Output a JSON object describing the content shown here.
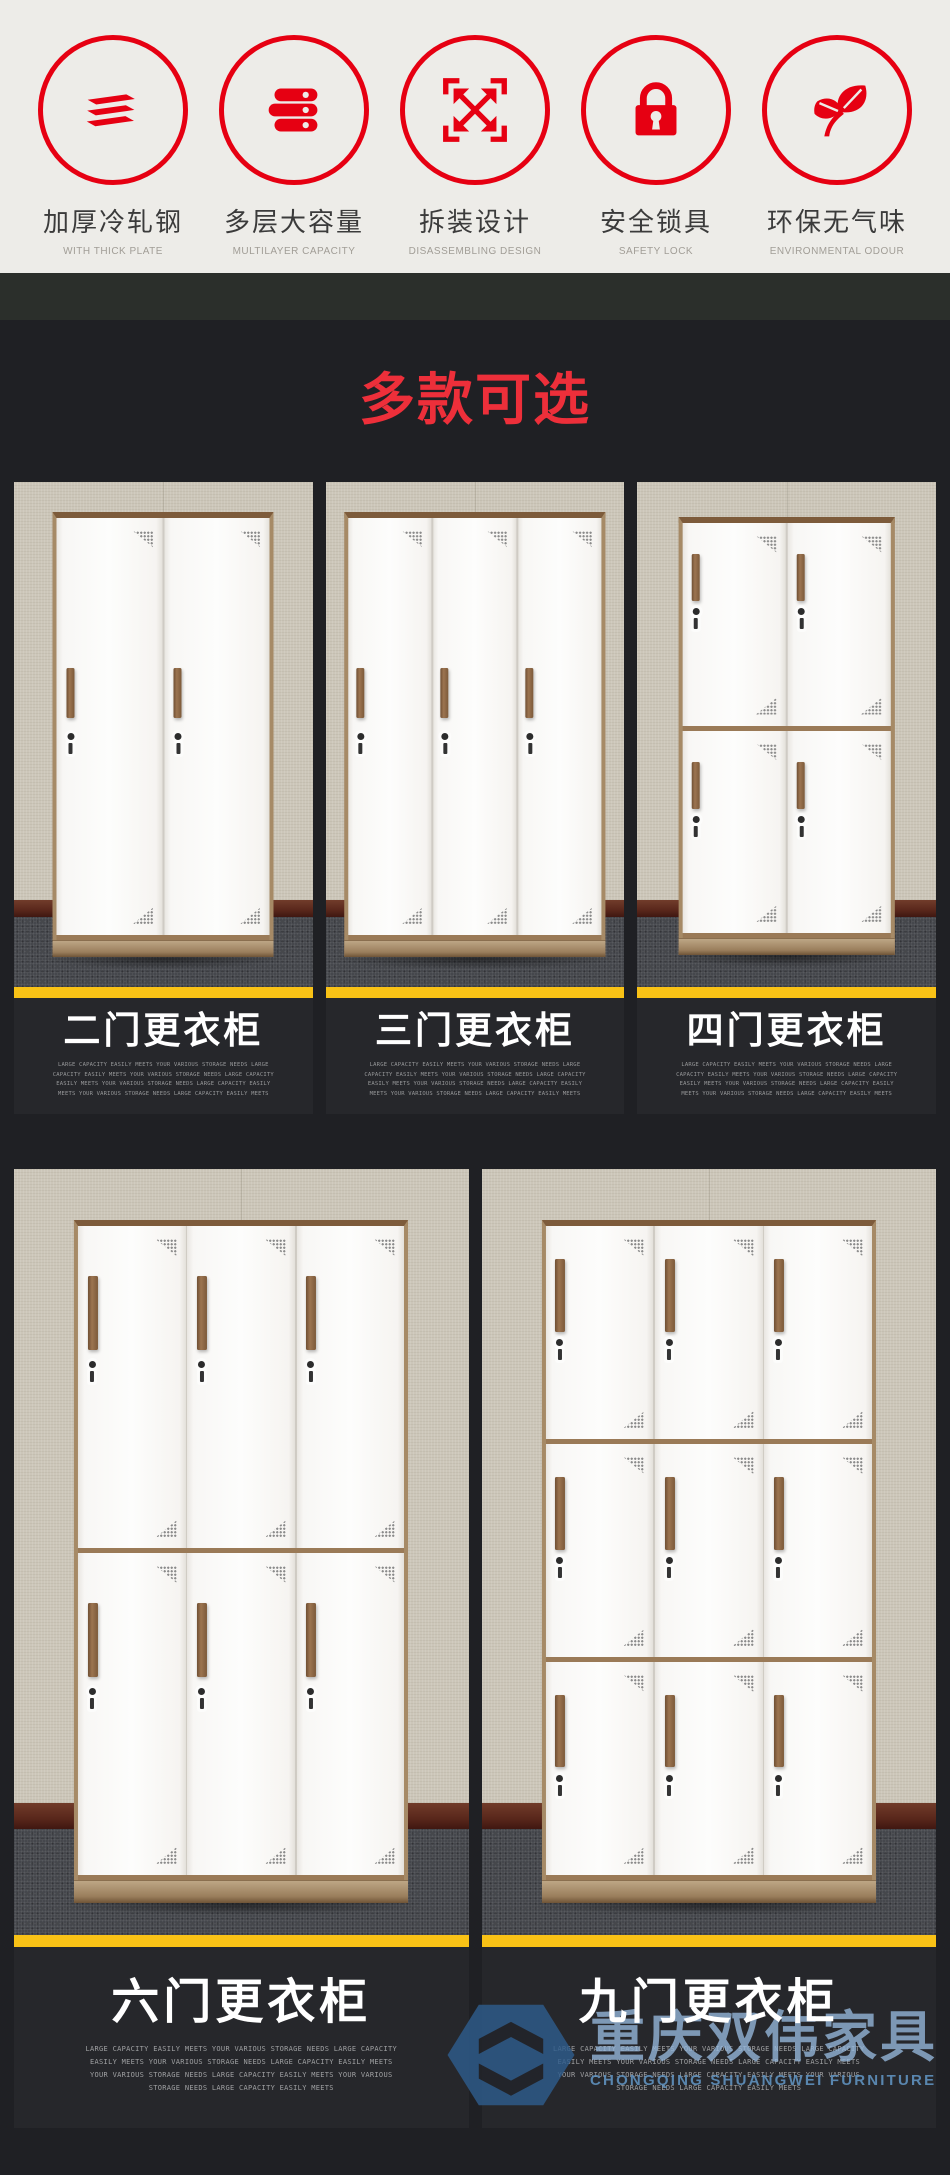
{
  "features": [
    {
      "icon": "layers-icon",
      "label": "加厚冷轧钢",
      "sublabel": "WITH THICK PLATE"
    },
    {
      "icon": "drawers-icon",
      "label": "多层大容量",
      "sublabel": "MULTILAYER CAPACITY"
    },
    {
      "icon": "disassemble-icon",
      "label": "拆装设计",
      "sublabel": "DISASSEMBLING DESIGN"
    },
    {
      "icon": "lock-icon",
      "label": "安全锁具",
      "sublabel": "SAFETY LOCK"
    },
    {
      "icon": "leaf-icon",
      "label": "环保无气味",
      "sublabel": "ENVIRONMENTAL ODOUR"
    }
  ],
  "section_title": "多款可选",
  "products": [
    {
      "name": "二门更衣柜",
      "doors": 2,
      "cols": 2,
      "rows": 1,
      "grid_row": 1,
      "desc": "LARGE CAPACITY EASILY MEETS YOUR VARIOUS STORAGE NEEDS LARGE CAPACITY EASILY MEETS YOUR VARIOUS STORAGE NEEDS LARGE CAPACITY EASILY MEETS YOUR VARIOUS STORAGE NEEDS LARGE CAPACITY EASILY MEETS YOUR VARIOUS STORAGE NEEDS LARGE CAPACITY EASILY MEETS"
    },
    {
      "name": "三门更衣柜",
      "doors": 3,
      "cols": 3,
      "rows": 1,
      "grid_row": 1,
      "desc": "LARGE CAPACITY EASILY MEETS YOUR VARIOUS STORAGE NEEDS LARGE CAPACITY EASILY MEETS YOUR VARIOUS STORAGE NEEDS LARGE CAPACITY EASILY MEETS YOUR VARIOUS STORAGE NEEDS LARGE CAPACITY EASILY MEETS YOUR VARIOUS STORAGE NEEDS LARGE CAPACITY EASILY MEETS"
    },
    {
      "name": "四门更衣柜",
      "doors": 4,
      "cols": 2,
      "rows": 2,
      "grid_row": 1,
      "desc": "LARGE CAPACITY EASILY MEETS YOUR VARIOUS STORAGE NEEDS LARGE CAPACITY EASILY MEETS YOUR VARIOUS STORAGE NEEDS LARGE CAPACITY EASILY MEETS YOUR VARIOUS STORAGE NEEDS LARGE CAPACITY EASILY MEETS YOUR VARIOUS STORAGE NEEDS LARGE CAPACITY EASILY MEETS"
    },
    {
      "name": "六门更衣柜",
      "doors": 6,
      "cols": 3,
      "rows": 2,
      "grid_row": 2,
      "desc": "LARGE CAPACITY EASILY MEETS YOUR VARIOUS STORAGE NEEDS LARGE CAPACITY EASILY MEETS YOUR VARIOUS STORAGE NEEDS LARGE CAPACITY EASILY MEETS YOUR VARIOUS STORAGE NEEDS LARGE CAPACITY EASILY MEETS YOUR VARIOUS STORAGE NEEDS LARGE CAPACITY EASILY MEETS"
    },
    {
      "name": "九门更衣柜",
      "doors": 9,
      "cols": 3,
      "rows": 3,
      "grid_row": 2,
      "desc": "LARGE CAPACITY EASILY MEETS YOUR VARIOUS STORAGE NEEDS LARGE CAPACITY EASILY MEETS YOUR VARIOUS STORAGE NEEDS LARGE CAPACITY EASILY MEETS YOUR VARIOUS STORAGE NEEDS LARGE CAPACITY EASILY MEETS YOUR VARIOUS STORAGE NEEDS LARGE CAPACITY EASILY MEETS"
    }
  ],
  "watermark": {
    "cn": "重庆双伟家具",
    "en": "CHONGQING SHUANGWEI FURNITURE"
  },
  "colors": {
    "accent_red": "#e60012",
    "title_red": "#ed2f3a",
    "stripe_yellow": "#f9c216",
    "watermark_blue": "#8fb4d6",
    "page_dark": "#1f2024",
    "card_dark": "#26272b"
  }
}
